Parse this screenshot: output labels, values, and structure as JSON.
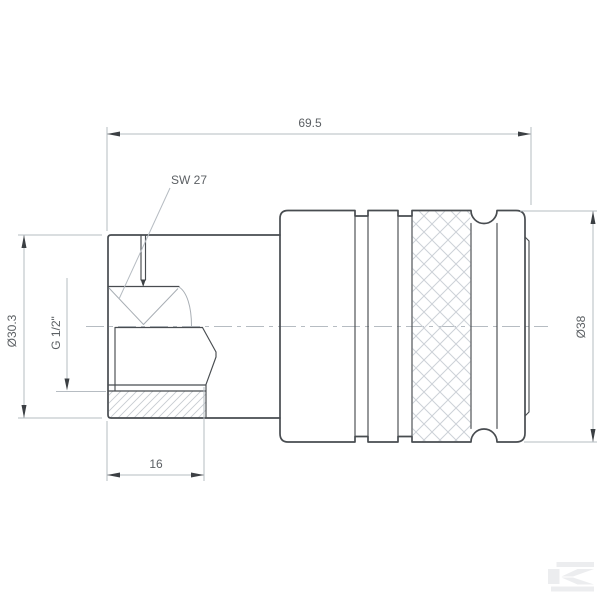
{
  "drawing": {
    "dimensions": {
      "overall_length": "69.5",
      "nut_diameter": "Ø30.3",
      "body_diameter": "Ø38",
      "thread_length": "16"
    },
    "annotations": {
      "wrench_size": "SW 27",
      "thread_size": "G 1/2\""
    },
    "colors": {
      "background": "#ffffff",
      "outline": "#484c50",
      "dimension_lines": "#b6bcc2",
      "hatch": "#c6cbd1",
      "text": "#5c6064",
      "watermark": "#ecedef"
    },
    "watermark_letter": "K"
  }
}
